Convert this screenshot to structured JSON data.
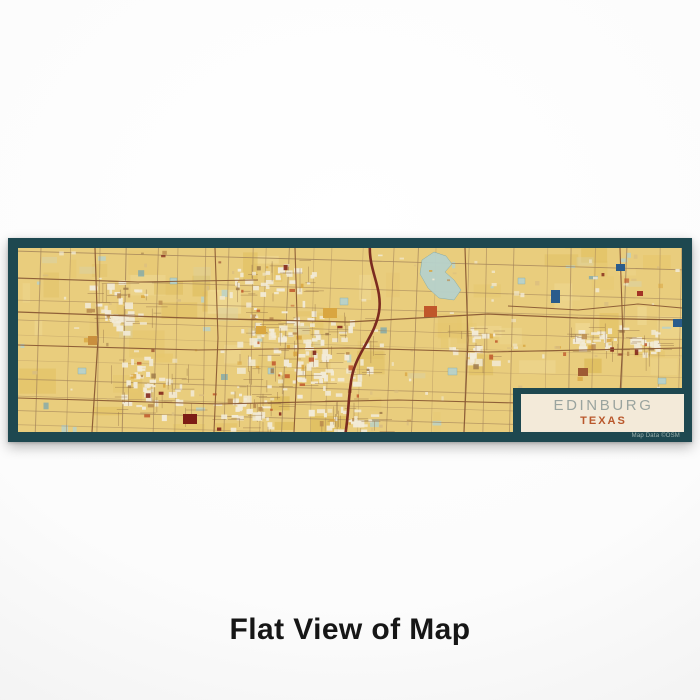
{
  "page": {
    "caption": "Flat View of Map",
    "caption_color": "#161616",
    "background_center": "#ffffff",
    "background_edge": "#e1e1e1"
  },
  "map_product": {
    "label": {
      "city": "EDINBURG",
      "state": "TEXAS",
      "city_color": "#9aa49f",
      "state_color": "#b9572b",
      "panel_bg": "#f3ead9"
    },
    "attribution": {
      "text": "Map Data ©OSM",
      "color": "#9fb4b0"
    },
    "frame_color": "#1e4850",
    "palette": {
      "map_bg": "#e9cd7d",
      "gold_variants": [
        "#e2c162",
        "#f0da96",
        "#e6c76e",
        "#dcba55"
      ],
      "vegetation": "#d9d2a6",
      "water": "#b7d2cc",
      "water_dark": "#7fa9ad",
      "urban": "#f2ebd8",
      "urban_tan": "#d9bd80",
      "road_minor": "#a3835a",
      "road_major": "#8a5a35",
      "road_urban": "#8f6b45",
      "highway": "#7b2b20",
      "blue_dark": "#2a5c8c",
      "accents": [
        "#b98a4e",
        "#c0572b",
        "#d9a640",
        "#9f7a4a",
        "#7d1d15"
      ]
    },
    "render": {
      "seed": 1337,
      "inner_width": 664,
      "inner_height": 184,
      "grid_rotation_deg": 1.6,
      "lake_points": "404,12 416,4 428,8 434,16 427,24 436,32 443,42 436,52 421,50 410,40 402,26",
      "highway_path": "M352,-4 C350,22 365,40 361,64 C357,88 339,104 334,128 C330,148 331,166 327,188",
      "major_roads": [
        {
          "points": "0,64 170,70 330,74 470,66 560,70 664,72",
          "w": 1.3
        },
        {
          "points": "0,97 180,102 330,100 470,104 664,100",
          "w": 1.1
        },
        {
          "points": "0,150 200,156 380,152 540,156 664,152",
          "w": 1.1
        },
        {
          "points": "0,30 120,34 240,32",
          "w": 1.0
        },
        {
          "points": "490,58 560,62 620,56 664,60",
          "w": 1.0
        },
        {
          "points": "77,0 80,92 74,184",
          "w": 1.2
        },
        {
          "points": "197,0 200,90 196,184",
          "w": 1.1
        },
        {
          "points": "277,0 280,100 276,184",
          "w": 1.1
        },
        {
          "points": "447,0 450,92 446,184",
          "w": 1.2
        },
        {
          "points": "602,0 605,90 600,184",
          "w": 1.1
        }
      ],
      "urban_clusters": [
        {
          "cx": 290,
          "cy": 106,
          "rx": 78,
          "ry": 56,
          "n": 95
        },
        {
          "cx": 255,
          "cy": 30,
          "rx": 48,
          "ry": 20,
          "n": 26
        },
        {
          "cx": 100,
          "cy": 58,
          "rx": 40,
          "ry": 28,
          "n": 30
        },
        {
          "cx": 132,
          "cy": 140,
          "rx": 46,
          "ry": 34,
          "n": 36
        },
        {
          "cx": 222,
          "cy": 162,
          "rx": 50,
          "ry": 22,
          "n": 28
        },
        {
          "cx": 455,
          "cy": 98,
          "rx": 30,
          "ry": 24,
          "n": 18
        },
        {
          "cx": 577,
          "cy": 90,
          "rx": 32,
          "ry": 18,
          "n": 24
        },
        {
          "cx": 624,
          "cy": 94,
          "rx": 24,
          "ry": 14,
          "n": 16
        },
        {
          "cx": 330,
          "cy": 170,
          "rx": 40,
          "ry": 16,
          "n": 20
        }
      ],
      "ponds": [
        {
          "x": 322,
          "y": 50,
          "w": 8,
          "h": 7
        },
        {
          "x": 500,
          "y": 30,
          "w": 7,
          "h": 6
        },
        {
          "x": 60,
          "y": 120,
          "w": 8,
          "h": 6
        },
        {
          "x": 152,
          "y": 30,
          "w": 7,
          "h": 6
        },
        {
          "x": 430,
          "y": 120,
          "w": 9,
          "h": 7
        },
        {
          "x": 250,
          "y": 120,
          "w": 6,
          "h": 6
        },
        {
          "x": 640,
          "y": 130,
          "w": 8,
          "h": 6
        },
        {
          "x": 520,
          "y": 150,
          "w": 7,
          "h": 5
        }
      ],
      "special_rects": [
        {
          "x": 406,
          "y": 58,
          "w": 13,
          "h": 11,
          "c": "#c0572b"
        },
        {
          "x": 165,
          "y": 166,
          "w": 14,
          "h": 10,
          "c": "#7d1d15"
        },
        {
          "x": 533,
          "y": 42,
          "w": 9,
          "h": 13,
          "c": "#2a5c8c"
        },
        {
          "x": 598,
          "y": 16,
          "w": 9,
          "h": 7,
          "c": "#2a5c8c"
        },
        {
          "x": 655,
          "y": 71,
          "w": 9,
          "h": 8,
          "c": "#2a5c8c"
        },
        {
          "x": 619,
          "y": 43,
          "w": 6,
          "h": 5,
          "c": "#a33326"
        },
        {
          "x": 305,
          "y": 60,
          "w": 14,
          "h": 10,
          "c": "#d9a640"
        },
        {
          "x": 238,
          "y": 78,
          "w": 10,
          "h": 8,
          "c": "#d9a640"
        },
        {
          "x": 560,
          "y": 120,
          "w": 10,
          "h": 8,
          "c": "#9f5b33"
        },
        {
          "x": 70,
          "y": 88,
          "w": 9,
          "h": 9,
          "c": "#c98f3e"
        }
      ]
    }
  }
}
